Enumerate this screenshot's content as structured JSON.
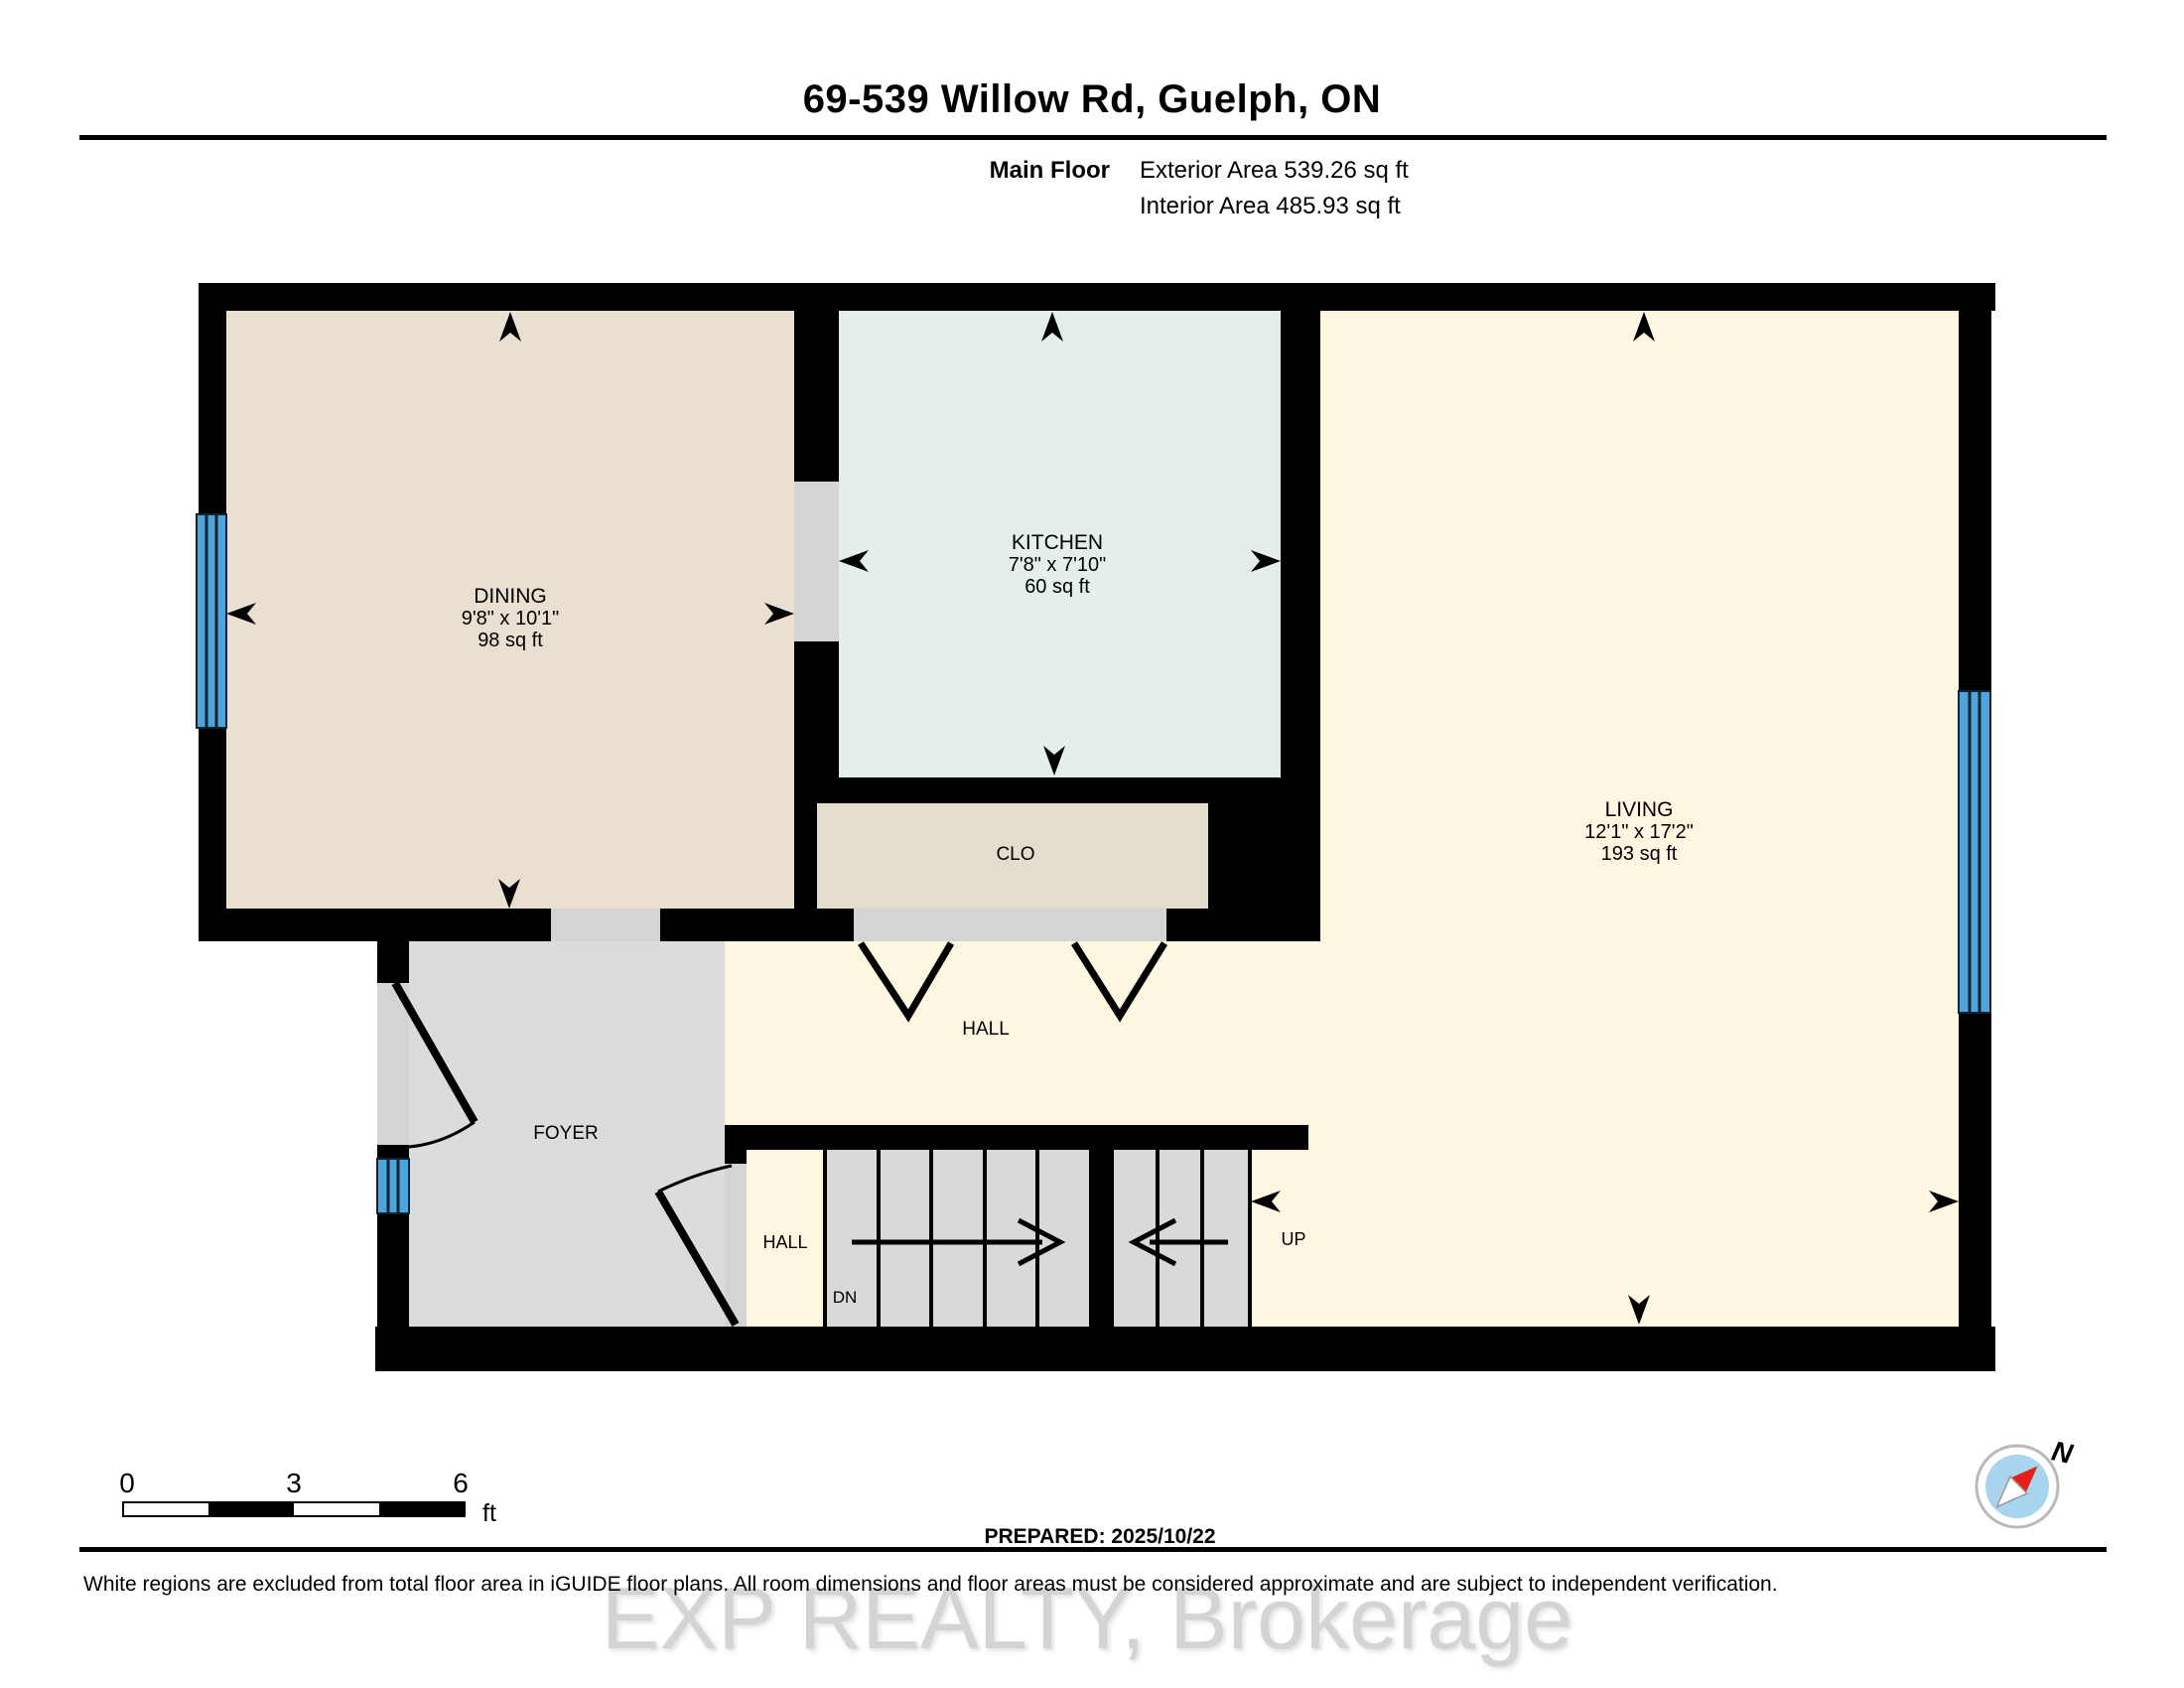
{
  "header": {
    "title": "69-539 Willow Rd, Guelph, ON",
    "floor_label": "Main Floor",
    "exterior_area": "Exterior Area 539.26 sq ft",
    "interior_area": "Interior Area 485.93 sq ft"
  },
  "rooms": [
    {
      "name": "DINING",
      "dims": "9'8\" x 10'1\"",
      "area": "98 sq ft"
    },
    {
      "name": "KITCHEN",
      "dims": "7'8\" x 7'10\"",
      "area": "60 sq ft"
    },
    {
      "name": "LIVING",
      "dims": "12'1\" x 17'2\"",
      "area": "193 sq ft"
    }
  ],
  "labels": {
    "closet": "CLO",
    "hall": "HALL",
    "foyer": "FOYER",
    "hall_lower": "HALL",
    "down": "DN",
    "up": "UP"
  },
  "scale_bar": {
    "zero": "0",
    "mid": "3",
    "end": "6",
    "unit": "ft"
  },
  "compass": {
    "north_label": "N"
  },
  "footer": {
    "prepared": "PREPARED: 2025/10/22",
    "disclaimer": "White regions are excluded from total floor area in iGUIDE floor plans. All room dimensions and floor areas must be considered approximate and are subject to independent verification."
  },
  "watermark": {
    "text": "EXP REALTY, Brokerage"
  },
  "colors": {
    "wall": "#000000",
    "dining_fill": "#e9e0d2",
    "kitchen_fill": "#e3efe8",
    "closet_fill": "#e4dccc",
    "living_hall_fill": "#fdf6e1",
    "foyer_fill": "#dcdcdc",
    "stairs_fill": "#d9d9d9",
    "threshold_fill": "#d4d4d4",
    "window_blue": "#4ea5d9",
    "compass_blue": "#a9d4f0",
    "compass_red": "#e32119",
    "watermark_gray": "#cdcdcd"
  }
}
